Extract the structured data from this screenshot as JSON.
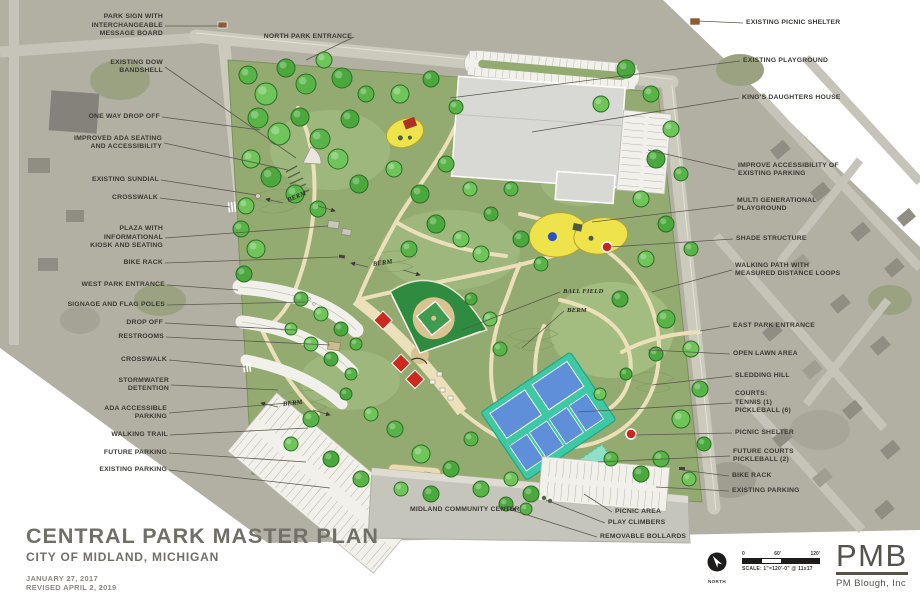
{
  "title_block": {
    "title": "CENTRAL PARK MASTER PLAN",
    "subtitle": "CITY OF MIDLAND, MICHIGAN",
    "date": "JANUARY 27, 2017",
    "revision": "REVISED APRIL 2, 2019"
  },
  "firm": {
    "logo": "PMB",
    "name": "PM Blough, Inc"
  },
  "compass": {
    "label": "NORTH"
  },
  "scale_bar": {
    "ticks": [
      "0",
      "60'",
      "120'"
    ],
    "caption": "SCALE: 1\"=120'-0\" @ 11x17"
  },
  "colors": {
    "park_green": "#93ab70",
    "aerial_gray": "#b2b0a3",
    "court_teal": "#3cc9a4",
    "court_blue": "#5e8fd8",
    "field_green": "#2e8b3f",
    "infield_tan": "#d9c391",
    "playground_yellow": "#efe34c",
    "feature_red": "#cf2418",
    "path_cream": "#ece0ba",
    "label_text": "#3b3934",
    "title_gray": "#716f68"
  },
  "callouts": {
    "left": [
      {
        "lines": [
          "PARK SIGN WITH",
          "INTERCHANGEABLE",
          "MESSAGE BOARD"
        ],
        "x": 163,
        "y": 26,
        "tx": 222,
        "ty": 26
      },
      {
        "lines": [
          "NORTH PARK ENTRANCE"
        ],
        "x": 352,
        "y": 37,
        "tx": 306,
        "ty": 60
      },
      {
        "lines": [
          "EXISTING DOW",
          "BANDSHELL"
        ],
        "x": 163,
        "y": 67,
        "tx": 296,
        "ty": 158
      },
      {
        "lines": [
          "ONE WAY DROP OFF"
        ],
        "x": 160,
        "y": 117,
        "tx": 260,
        "ty": 130
      },
      {
        "lines": [
          "IMPROVED ADA SEATING",
          "AND ACCESSIBILITY"
        ],
        "x": 162,
        "y": 143,
        "tx": 288,
        "ty": 170
      },
      {
        "lines": [
          "EXISTING SUNDIAL"
        ],
        "x": 159,
        "y": 180,
        "tx": 256,
        "ty": 195
      },
      {
        "lines": [
          "CROSSWALK"
        ],
        "x": 158,
        "y": 198,
        "tx": 230,
        "ty": 207
      },
      {
        "lines": [
          "PLAZA WITH",
          "INFORMATIONAL",
          "KIOSK AND SEATING"
        ],
        "x": 163,
        "y": 238,
        "tx": 328,
        "ty": 226
      },
      {
        "lines": [
          "BIKE RACK"
        ],
        "x": 163,
        "y": 263,
        "tx": 338,
        "ty": 257
      },
      {
        "lines": [
          "WEST PARK ENTRANCE"
        ],
        "x": 165,
        "y": 285,
        "tx": 238,
        "ty": 290
      },
      {
        "lines": [
          "SIGNAGE AND FLAG POLES"
        ],
        "x": 165,
        "y": 305,
        "tx": 306,
        "ty": 302
      },
      {
        "lines": [
          "DROP OFF"
        ],
        "x": 163,
        "y": 323,
        "tx": 296,
        "ty": 330
      },
      {
        "lines": [
          "RESTROOMS"
        ],
        "x": 164,
        "y": 337,
        "tx": 330,
        "ty": 345
      },
      {
        "lines": [
          "CROSSWALK"
        ],
        "x": 167,
        "y": 360,
        "tx": 245,
        "ty": 367
      },
      {
        "lines": [
          "STORMWATER",
          "DETENTION"
        ],
        "x": 169,
        "y": 385,
        "tx": 278,
        "ty": 390
      },
      {
        "lines": [
          "ADA ACCESSIBLE",
          "PARKING"
        ],
        "x": 167,
        "y": 413,
        "tx": 300,
        "ty": 402
      },
      {
        "lines": [
          "WALKING TRAIL"
        ],
        "x": 168,
        "y": 435,
        "tx": 308,
        "ty": 428
      },
      {
        "lines": [
          "FUTURE PARKING"
        ],
        "x": 167,
        "y": 453,
        "tx": 306,
        "ty": 462
      },
      {
        "lines": [
          "EXISTING PARKING"
        ],
        "x": 167,
        "y": 470,
        "tx": 330,
        "ty": 488
      }
    ],
    "right": [
      {
        "lines": [
          "EXISTING PICNIC SHELTER"
        ],
        "x": 746,
        "y": 23,
        "tx": 698,
        "ty": 21
      },
      {
        "lines": [
          "EXISTING PLAYGROUND"
        ],
        "x": 743,
        "y": 61,
        "tx": 450,
        "ty": 98
      },
      {
        "lines": [
          "KING'S DAUGHTERS HOUSE"
        ],
        "x": 742,
        "y": 98,
        "tx": 532,
        "ty": 132
      },
      {
        "lines": [
          "IMPROVE ACCESSIBILITY OF",
          "EXISTING PARKING"
        ],
        "x": 738,
        "y": 170,
        "tx": 648,
        "ty": 150
      },
      {
        "lines": [
          "MULTI GENERATIONAL",
          "PLAYGROUND"
        ],
        "x": 737,
        "y": 205,
        "tx": 592,
        "ty": 222
      },
      {
        "lines": [
          "SHADE STRUCTURE"
        ],
        "x": 736,
        "y": 239,
        "tx": 610,
        "ty": 247
      },
      {
        "lines": [
          "WALKING PATH WITH",
          "MEASURED DISTANCE LOOPS"
        ],
        "x": 735,
        "y": 270,
        "tx": 652,
        "ty": 292
      },
      {
        "lines": [
          "EAST PARK ENTRANCE"
        ],
        "x": 733,
        "y": 326,
        "tx": 700,
        "ty": 331
      },
      {
        "lines": [
          "OPEN LAWN AREA"
        ],
        "x": 733,
        "y": 354,
        "tx": 648,
        "ty": 350
      },
      {
        "lines": [
          "SLEDDING HILL"
        ],
        "x": 735,
        "y": 376,
        "tx": 652,
        "ty": 385
      },
      {
        "lines": [
          "COURTS:",
          "TENNIS (1)",
          "PICKLEBALL (6)"
        ],
        "x": 735,
        "y": 403,
        "tx": 578,
        "ty": 412
      },
      {
        "lines": [
          "PICNIC SHELTER"
        ],
        "x": 735,
        "y": 433,
        "tx": 636,
        "ty": 435
      },
      {
        "lines": [
          "FUTURE COURTS",
          "PICKLEBALL (2)"
        ],
        "x": 733,
        "y": 456,
        "tx": 598,
        "ty": 462
      },
      {
        "lines": [
          "BIKE RACK"
        ],
        "x": 732,
        "y": 476,
        "tx": 682,
        "ty": 470
      },
      {
        "lines": [
          "EXISTING PARKING"
        ],
        "x": 732,
        "y": 491,
        "tx": 656,
        "ty": 487
      }
    ],
    "inner": [
      {
        "lines": [
          "BERM"
        ],
        "x": 288,
        "y": 201,
        "rot": -22,
        "serif": true,
        "arrows": true
      },
      {
        "lines": [
          "BERM"
        ],
        "x": 373,
        "y": 265,
        "rot": -8,
        "serif": true,
        "arrows": true
      },
      {
        "lines": [
          "BALL FIELD"
        ],
        "x": 563,
        "y": 292,
        "serif": true,
        "tx": 462,
        "ty": 330
      },
      {
        "lines": [
          "BERM"
        ],
        "x": 567,
        "y": 311,
        "serif": true,
        "tx": 522,
        "ty": 348
      },
      {
        "lines": [
          "BERM"
        ],
        "x": 283,
        "y": 405,
        "rot": -6,
        "serif": true,
        "arrows": true
      },
      {
        "lines": [
          "MIDLAND COMMUNITY CENTER"
        ],
        "x": 410,
        "y": 510
      },
      {
        "lines": [
          "PICNIC AREA"
        ],
        "x": 615,
        "y": 512,
        "tx": 584,
        "ty": 494
      },
      {
        "lines": [
          "PLAY CLIMBERS"
        ],
        "x": 608,
        "y": 523,
        "tx": 546,
        "ty": 500
      },
      {
        "lines": [
          "REMOVABLE BOLLARDS"
        ],
        "x": 600,
        "y": 537,
        "tx": 502,
        "ty": 507
      }
    ]
  }
}
